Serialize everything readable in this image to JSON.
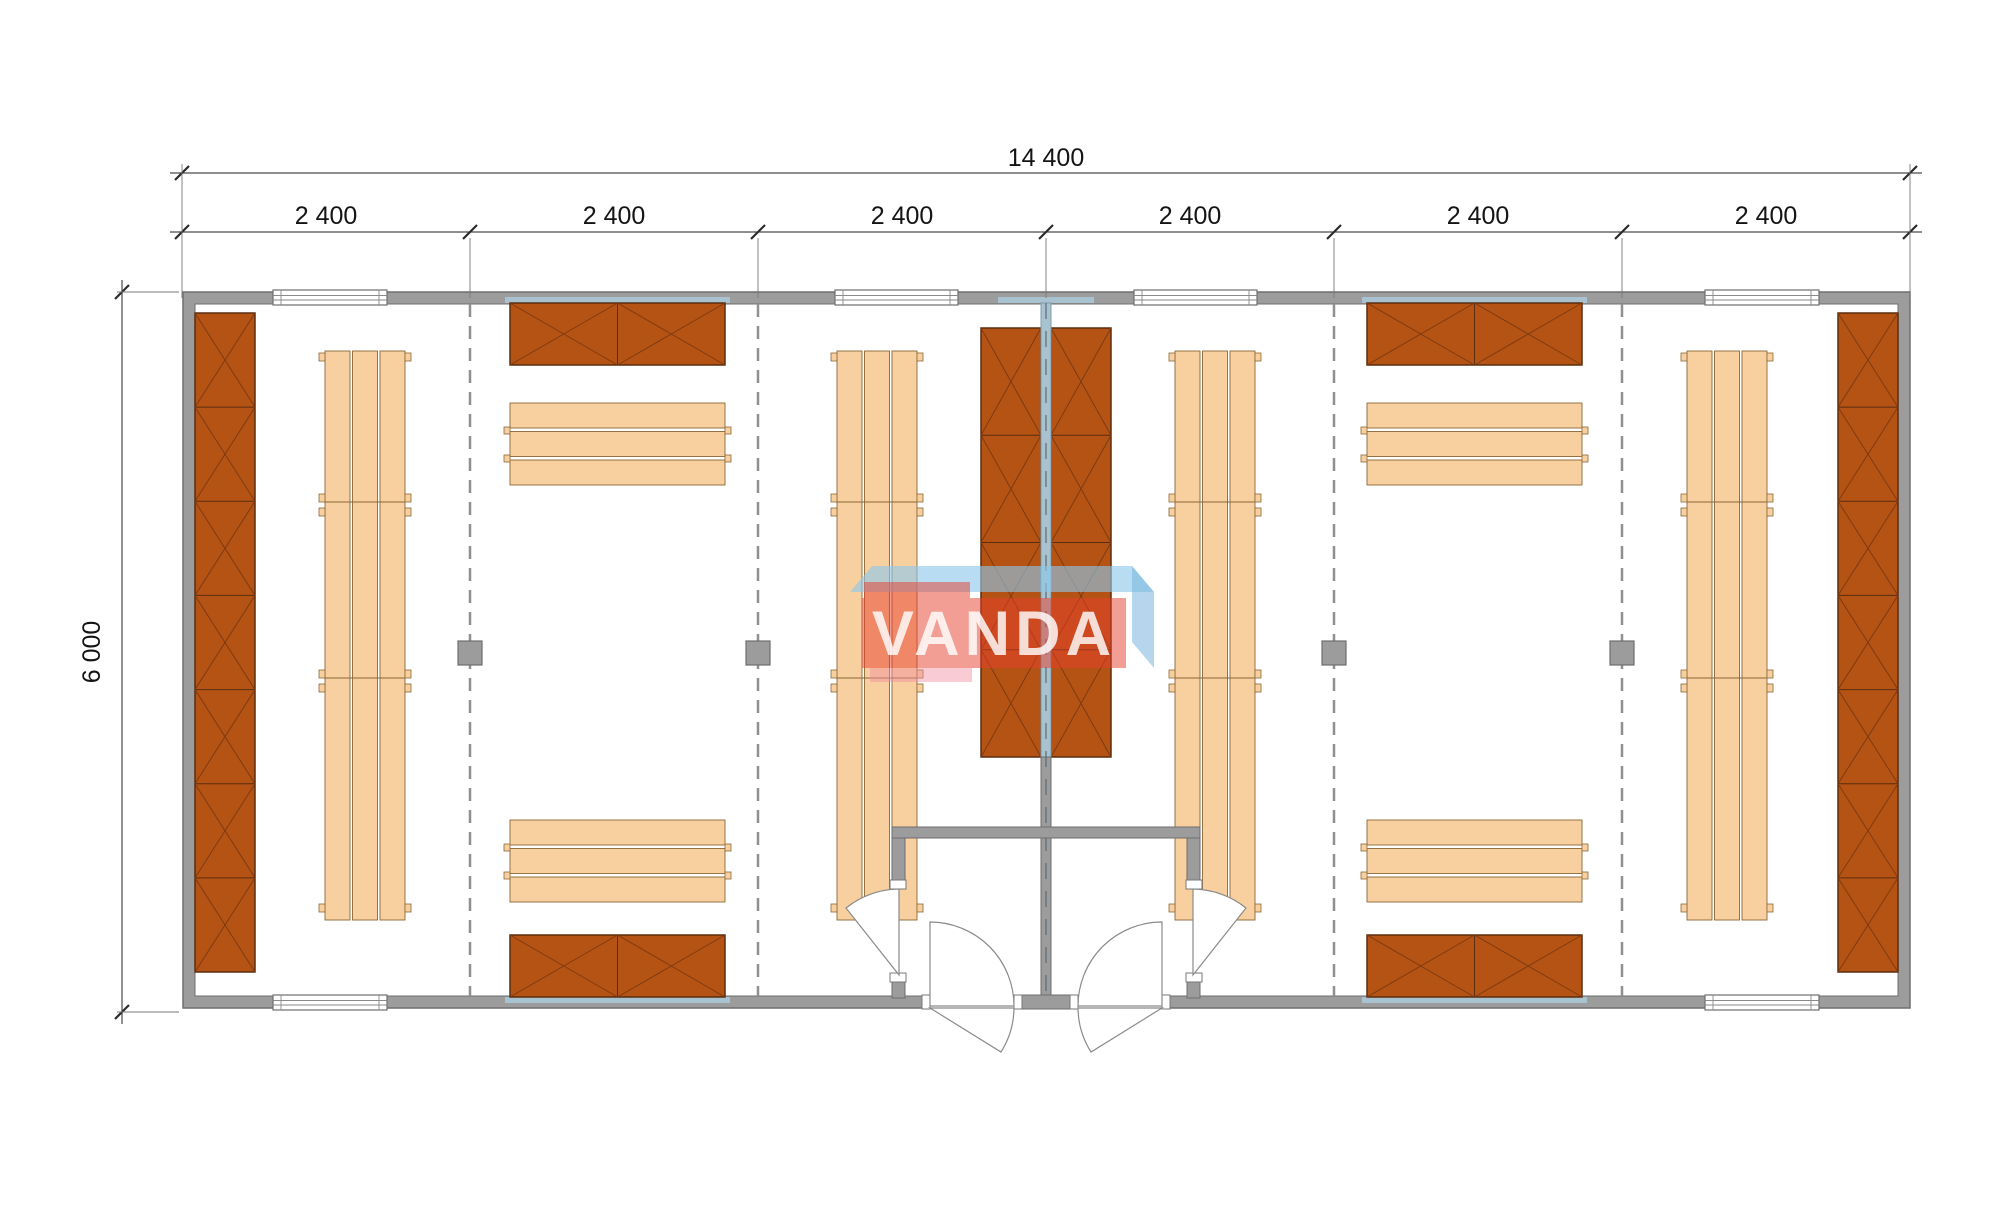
{
  "dimensions": {
    "overall_width": {
      "label": "14 400"
    },
    "modules": [
      {
        "label": "2 400"
      },
      {
        "label": "2 400"
      },
      {
        "label": "2 400"
      },
      {
        "label": "2 400"
      },
      {
        "label": "2 400"
      },
      {
        "label": "2 400"
      }
    ],
    "overall_height": {
      "label": "6 000"
    }
  },
  "watermark": {
    "text": "VANDA"
  },
  "colors": {
    "wall": "#9c9c9c",
    "wall_edge": "#6e6e6e",
    "floor": "#ffffff",
    "sauna_wall": "#a9c2cf",
    "sauna_wall_edge": "#7e9dad",
    "panel": "#b55315",
    "panel_edge": "#5a2d0e",
    "panel_line": "#7e3a10",
    "bench": "#f8d0a0",
    "bench_edge": "#8a6636",
    "dash": "#909090",
    "column": "#9c9c9c",
    "door_arc": "#8a8a8a",
    "dim_line": "#4a4a4a",
    "ext_line": "#787878",
    "tick": "#2b2b2b",
    "dim_text": "#141414",
    "watermark_blue": "rgba(140,200,235,0.62)",
    "watermark_blue2": "rgba(120,180,220,0.55)",
    "watermark_red": "rgba(232,62,44,0.5)",
    "watermark_pink": "rgba(242,140,160,0.45)"
  },
  "plan": {
    "outer_wall": {
      "x": 183,
      "y": 292,
      "w": 1727,
      "h": 716,
      "t": 12
    },
    "dim_line_top_y": 173,
    "dim_line_modules_y": 232,
    "dim_line_left_x": 122,
    "module_ticks_x": [
      182,
      470,
      758,
      1046,
      1334,
      1622,
      1910
    ],
    "module_label_centers_x": [
      326,
      614,
      902,
      1190,
      1478,
      1766
    ],
    "bay_lines_x": [
      470,
      758,
      1334,
      1622
    ],
    "columns": [
      {
        "cx": 470,
        "cy": 653
      },
      {
        "cx": 758,
        "cy": 653
      },
      {
        "cx": 1334,
        "cy": 653
      },
      {
        "cx": 1622,
        "cy": 653
      }
    ],
    "windows_top": [
      [
        273,
        387
      ],
      [
        835,
        958
      ],
      [
        1134,
        1257
      ],
      [
        1705,
        1819
      ]
    ],
    "windows_bottom": [
      [
        273,
        387
      ],
      [
        1705,
        1819
      ]
    ],
    "sauna_strips": [
      [
        505,
        297,
        225
      ],
      [
        1362,
        297,
        225
      ],
      [
        998,
        297,
        96
      ],
      [
        505,
        997,
        225
      ],
      [
        1362,
        997,
        225
      ]
    ],
    "panels_vertical": [
      {
        "x": 195,
        "y": 313,
        "w": 60,
        "h": 659,
        "seg": 7
      },
      {
        "x": 981,
        "y": 328,
        "w": 60,
        "h": 429,
        "seg": 4
      },
      {
        "x": 1051,
        "y": 328,
        "w": 60,
        "h": 429,
        "seg": 4
      },
      {
        "x": 1838,
        "y": 313,
        "w": 60,
        "h": 659,
        "seg": 7
      }
    ],
    "panels_horizontal": [
      {
        "x": 510,
        "y": 303,
        "w": 215,
        "h": 62,
        "seg": 2
      },
      {
        "x": 510,
        "y": 935,
        "w": 215,
        "h": 62,
        "seg": 2
      },
      {
        "x": 1367,
        "y": 303,
        "w": 215,
        "h": 62,
        "seg": 2
      },
      {
        "x": 1367,
        "y": 935,
        "w": 215,
        "h": 62,
        "seg": 2
      }
    ],
    "benches_vertical": [
      {
        "x": 325,
        "y": 351,
        "w": 80,
        "h": 569
      },
      {
        "x": 837,
        "y": 351,
        "w": 80,
        "h": 569
      },
      {
        "x": 1175,
        "y": 351,
        "w": 80,
        "h": 569
      },
      {
        "x": 1687,
        "y": 351,
        "w": 80,
        "h": 569
      }
    ],
    "bench_v_joints": [
      151,
      327
    ],
    "bench_v_tabs": [
      2,
      143,
      157,
      319,
      333,
      553
    ],
    "benches_horizontal": [
      {
        "x": 510,
        "y": 403,
        "w": 215,
        "h": 82
      },
      {
        "x": 510,
        "y": 820,
        "w": 215,
        "h": 82
      },
      {
        "x": 1367,
        "y": 403,
        "w": 215,
        "h": 82
      },
      {
        "x": 1367,
        "y": 820,
        "w": 215,
        "h": 82
      }
    ],
    "bench_h_tabs": [
      24,
      52
    ],
    "center_wall": {
      "x": 1041,
      "w": 10,
      "y1": 303,
      "y2": 1008,
      "blue_to": 757
    },
    "vestibule": {
      "top_wall": {
        "x": 892,
        "y": 827,
        "w": 308,
        "h": 11
      },
      "stubs": [
        {
          "x": 892,
          "y": 838,
          "w": 13,
          "h": 42
        },
        {
          "x": 1187,
          "y": 838,
          "w": 13,
          "h": 42
        }
      ],
      "feet": [
        {
          "x": 892,
          "y": 982,
          "w": 13,
          "h": 16
        },
        {
          "x": 1187,
          "y": 982,
          "w": 13,
          "h": 16
        }
      ],
      "jambs": [
        {
          "x": 890,
          "y": 880,
          "w": 16,
          "h": 9
        },
        {
          "x": 1186,
          "y": 880,
          "w": 16,
          "h": 9
        },
        {
          "x": 890,
          "y": 973,
          "w": 16,
          "h": 9
        },
        {
          "x": 1186,
          "y": 973,
          "w": 16,
          "h": 9
        }
      ],
      "t_block": {
        "x": 1022,
        "y": 995,
        "w": 48,
        "h": 14
      }
    },
    "bottom_openings": [
      {
        "x": 930,
        "w": 84
      },
      {
        "x": 1078,
        "w": 84
      }
    ],
    "bottom_jambs": [
      922,
      1014,
      1070,
      1162
    ],
    "doors": [
      "M899,975 L899,889 A86,86 0 0 0 846,908 Z",
      "M930,1006 L930,922 A84,84 0 0 1 1014,1006 Z",
      "M930,1008 L1001,1052 A84,84 0 0 0 1014,1008 Z",
      "M1193,975 L1193,889 A86,86 0 0 1 1246,908 Z",
      "M1162,1006 L1162,922 A84,84 0 0 0 1078,1006 Z",
      "M1162,1008 L1091,1052 A84,84 0 0 1 1078,1008 Z"
    ],
    "watermark_shapes": [
      {
        "pts": "850,592 872,566 1132,566 1154,592",
        "color_key": "watermark_blue"
      },
      {
        "pts": "1132,566 1154,592 1154,668 1132,642",
        "color_key": "watermark_blue2"
      },
      {
        "pts": "864,582 970,582 970,598 864,598",
        "color_key": "watermark_red"
      },
      {
        "pts": "862,598 1126,598 1126,668 862,668",
        "color_key": "watermark_red"
      },
      {
        "pts": "870,668 972,668 972,682 870,682",
        "color_key": "watermark_pink"
      }
    ]
  }
}
